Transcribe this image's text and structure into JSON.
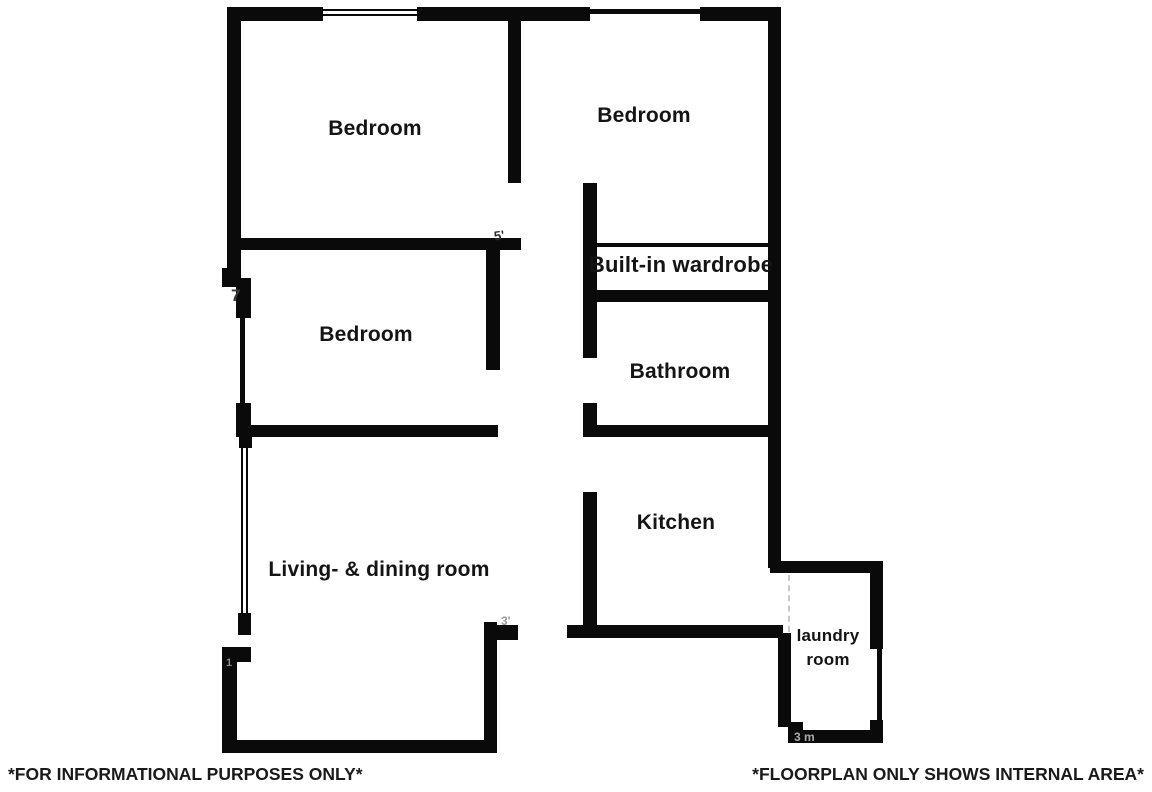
{
  "rooms": {
    "bedroom_top_left": "Bedroom",
    "bedroom_top_right": "Bedroom",
    "bedroom_middle": "Bedroom",
    "wardrobe": "Built-in wardrobe",
    "bathroom": "Bathroom",
    "living_dining": "Living- & dining room",
    "kitchen": "Kitchen",
    "laundry": "laundry room"
  },
  "footer": {
    "left_note": "*FOR INFORMATIONAL PURPOSES ONLY*",
    "right_note": "*FLOORPLAN ONLY SHOWS INTERNAL AREA*"
  },
  "remnants": {
    "left_wall_mark": "7",
    "bedroom_door_mark": "5'",
    "living_step_mark": "3'",
    "left_lower_mark": "1",
    "laundry_bottom_mark": "3 m"
  },
  "colors": {
    "wall": "#0a0a0a",
    "background": "#ffffff",
    "remnant": "#8a8a8a"
  }
}
